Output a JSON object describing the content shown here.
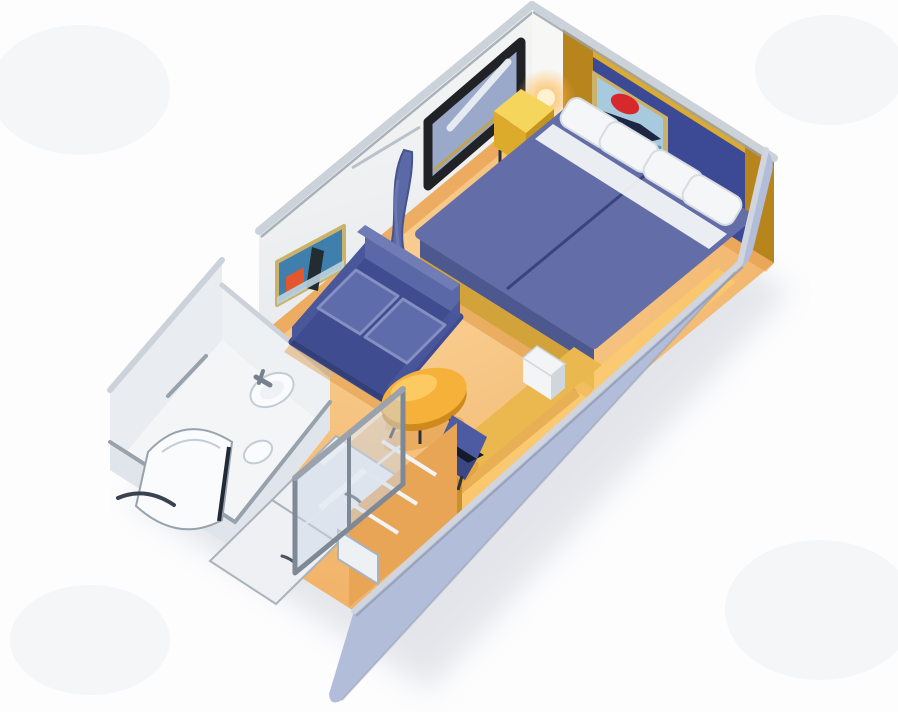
{
  "scene": {
    "description": "3D isometric cutaway illustration of a cruise-ship stateroom floor plan, rotated diagonally on a white background",
    "objects": [
      {
        "name": "twin-beds",
        "label": "Two twin beds pushed together with blue bedspreads, white pillows and gold base trim"
      },
      {
        "name": "headboard-artwork",
        "label": "Framed artwork on blue headboard wall"
      },
      {
        "name": "wall-lamp",
        "label": "Glowing wall lamp on gold corner post"
      },
      {
        "name": "nightstand",
        "label": "Yellow bedside table"
      },
      {
        "name": "wall-mirror",
        "label": "Dark framed mirror on back wall"
      },
      {
        "name": "left-wall-art",
        "label": "Colorful framed picture on side wall"
      },
      {
        "name": "privacy-curtain",
        "label": "Blue room-divider curtain"
      },
      {
        "name": "sofa",
        "label": "Blue two-seat sofa"
      },
      {
        "name": "coffee-table",
        "label": "Orange oval coffee table"
      },
      {
        "name": "armchair",
        "label": "Small blue chair"
      },
      {
        "name": "vanity-desk",
        "label": "Desk counter along right wall with white appliance"
      },
      {
        "name": "bathroom",
        "label": "Bathroom with curved shower, sink, toilet and towel bar"
      },
      {
        "name": "wardrobe",
        "label": "White wardrobe doors with handles"
      },
      {
        "name": "closet",
        "label": "Closet with shelves behind sliding glass doors"
      },
      {
        "name": "carpet",
        "label": "Orange-tan carpet floor"
      }
    ]
  },
  "colors": {
    "bg": "#fdfdfe",
    "blotch": "#f1f2f5",
    "shadow": "#aeb6c2",
    "floor": "#f0ae61",
    "floor_light": "#f9d094",
    "floor_dark": "#e2923b",
    "floor_glow": "#ffd266",
    "floor_shadow": "#d98c30",
    "wall_white": "#f7f8f6",
    "wall_white_dim": "#e8ebee",
    "cap_light": "#ccd2d9",
    "cap_dark": "#99a2ad",
    "hb_blue": "#3c4a96",
    "gold": "#b8841c",
    "gold_light": "#dcab32",
    "gold_dark": "#8f6512",
    "art1_bg": "#a8cade",
    "art1_red": "#d7282c",
    "art1_dark": "#1c2542",
    "art1_teal": "#4d7f9e",
    "art_frame": "#cbb26b",
    "art2_teal": "#3f7fae",
    "art2_orange": "#e2572e",
    "art2_dark": "#232c31",
    "art2_light": "#bcd3de",
    "mirror_frame": "#202226",
    "mirror_glass": "#9aa9ca",
    "mirror_streak": "#eef2f6",
    "mirror_gold": "#caa23c",
    "bed_spread": "#636ea8",
    "bed_spread_dark": "#4d588f",
    "bed_seam": "#39437c",
    "bed_gold": "#d3a33b",
    "sheet_white": "#f1f3f5",
    "pillow": "#f4f6f8",
    "pillow_shade": "#d6dce2",
    "nt_top": "#f6d55c",
    "nt_front": "#dcab2b",
    "nt_side": "#c3931f",
    "lamp_glow": "#ffb84d",
    "lamp_core": "#fff3d8",
    "curtain": "#5b69a6",
    "curtain_dark": "#46538c",
    "curtain_fold": "#7280b8",
    "sofa_base": "#3f4c90",
    "sofa_back": "#5a68a8",
    "sofa_top": "#6f7cb5",
    "sofa_arm": "#4a579b",
    "sofa_cushion": "#5e6cab",
    "sofa_cushion_edge": "#8490c1",
    "sofa_shadow": "#2c3768",
    "table_top": "#f5b13a",
    "table_rim": "#cf8a1d",
    "table_hl": "#ffcf6b",
    "leg": "#2b3138",
    "chair_back": "#4d5ca2",
    "chair_seat": "#3a4784",
    "chair_shadow": "#141b2e",
    "desk_top": "#eab84e",
    "desk_side": "#c9922c",
    "desk_shadow": "#cf8a2a",
    "tv": "#f2f4f6",
    "tv_side": "#cfd6dc",
    "bath_wall": "#e9edf1",
    "bath_wall2": "#eef1f4",
    "bath_low": "#dfe5ea",
    "bath_floor": "#f3f5f6",
    "bath_trim": "#98a2ad",
    "bath_dark": "#222a38",
    "fixture": "#fafbfc",
    "fixture_inner": "#eef2f5",
    "fixture_gray": "#76818d",
    "fixture_line": "#c3ccd4",
    "swoosh": "#39424e",
    "cab": "#eef0f3",
    "cab_line": "#aab2bc",
    "handle": "#4a5560",
    "closet_back": "#e8a556",
    "shelf": "#f2f4f6",
    "glass": "#ccd8e8",
    "glass_frame": "#7f8995",
    "glass_sheen": "#ffffff",
    "drawer": "#eef1f4",
    "rwall": "#b2bdda",
    "rwall_cap": "#d0d5de",
    "rwall_edge": "#8d96a8"
  }
}
